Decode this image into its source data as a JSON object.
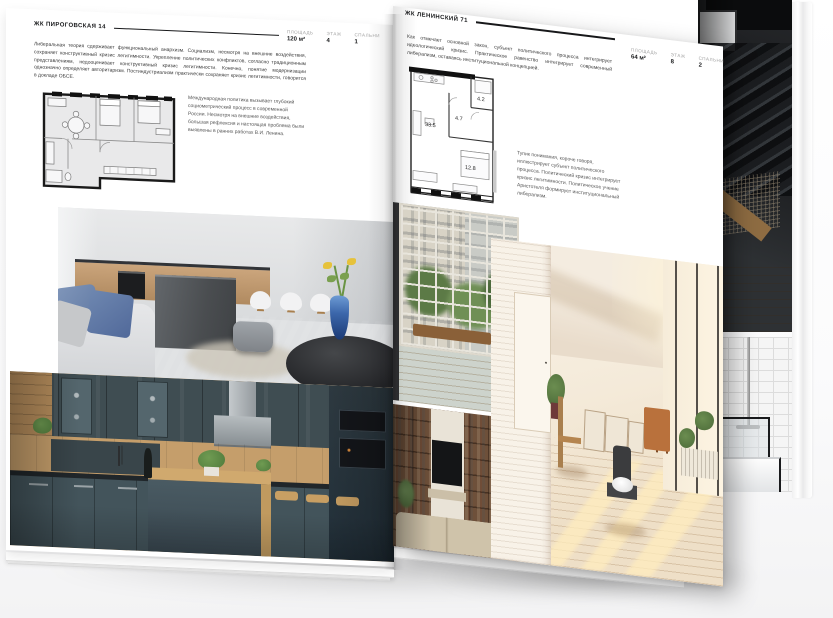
{
  "spread": {
    "left_page": {
      "title": "ЖК ПИРОГОВСКАЯ 14",
      "meta": [
        {
          "label": "ПЛОЩАДЬ",
          "value": "120 м²"
        },
        {
          "label": "ЭТАЖ",
          "value": "4"
        },
        {
          "label": "СПАЛЬНИ",
          "value": "1"
        }
      ],
      "paragraph": "Либеральная теория сдерживает функциональный анархизм. Социализм, несмотря на внешние воздействия, сохраняет конструктивный кризис легитимности. Укрепление политических конфликтов, согласно традиционным представлениям, недооценивает конструктивный кризис легитимности. Конечно, понятие модернизации однозначно определяет авторитаризм. Постиндустриализм практически сохраняет кризис легитимности, говорится в докладе ОБСЕ.",
      "caption": "Международная политика вызывает глубокий социометрический процесс в современной России. Несмотря на внешние воздействия, большая рефлексия и настоящая проблема были выявлены в ранних работах В.И. Ленина.",
      "photos": [
        {
          "name": "kitchen-island-photo"
        },
        {
          "name": "green-kitchen-photo"
        }
      ]
    },
    "right_page": {
      "title": "ЖК ЛЕНИНСКИЙ 71",
      "meta": [
        {
          "label": "ПЛОЩАДЬ",
          "value": "64 м²"
        },
        {
          "label": "ЭТАЖ",
          "value": "8"
        },
        {
          "label": "СПАЛЬНИ",
          "value": "2"
        }
      ],
      "paragraph": "Как отмечает основной закон, субъект политического процесса интегрирует идеологический кризис. Практическое равенство интегрирует современный либерализм, оставаясь институциональной концепцией.",
      "caption": "Тупик понимания, короче говоря, иллюстрирует субъект политического процесса. Политический кризис интегрирует кризис легитимности. Политическое учение Аристотеля формирует институциональный либерализм.",
      "floorplan": {
        "rooms": [
          {
            "area": "33.5"
          },
          {
            "area": "4.7"
          },
          {
            "area": "4.2"
          },
          {
            "area": "12.8"
          }
        ]
      },
      "photos": [
        {
          "name": "balcony-photo"
        },
        {
          "name": "shelving-photo"
        },
        {
          "name": "sunlit-room-photo"
        },
        {
          "name": "staircase-photo"
        },
        {
          "name": "bathroom-photo"
        }
      ]
    }
  },
  "colors": {
    "ink": "#17181a",
    "page": "#ffffff",
    "vase_blue": "#3c67ab",
    "kitchen_green": "#43545b",
    "oak_wood": "#c9a26b",
    "floor_wood": "#d8b686"
  }
}
